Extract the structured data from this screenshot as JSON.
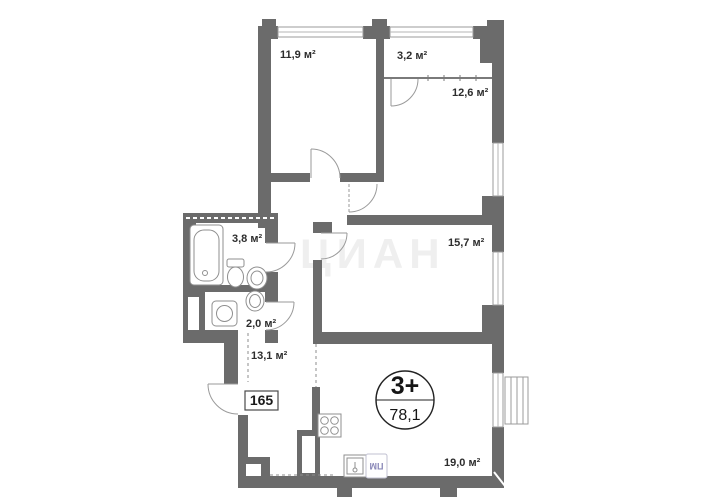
{
  "plan": {
    "unit_number": "165",
    "badge": {
      "type_label": "3+",
      "total_area": "78,1"
    },
    "watermark": "ЦИАН",
    "appliance_label": "ПМ",
    "rooms": {
      "living_11_9": "11,9 м²",
      "closet_3_2": "3,2 м²",
      "bedroom_12_6": "12,6 м²",
      "bath_3_8": "3,8 м²",
      "bedroom_15_7": "15,7 м²",
      "wc_2_0": "2,0 м²",
      "hall_13_1": "13,1 м²",
      "kitchen_living_19_0": "19,0 м²"
    },
    "colors": {
      "wall": "#6b6b6b",
      "appliance_accent": "#8a88b8"
    }
  }
}
